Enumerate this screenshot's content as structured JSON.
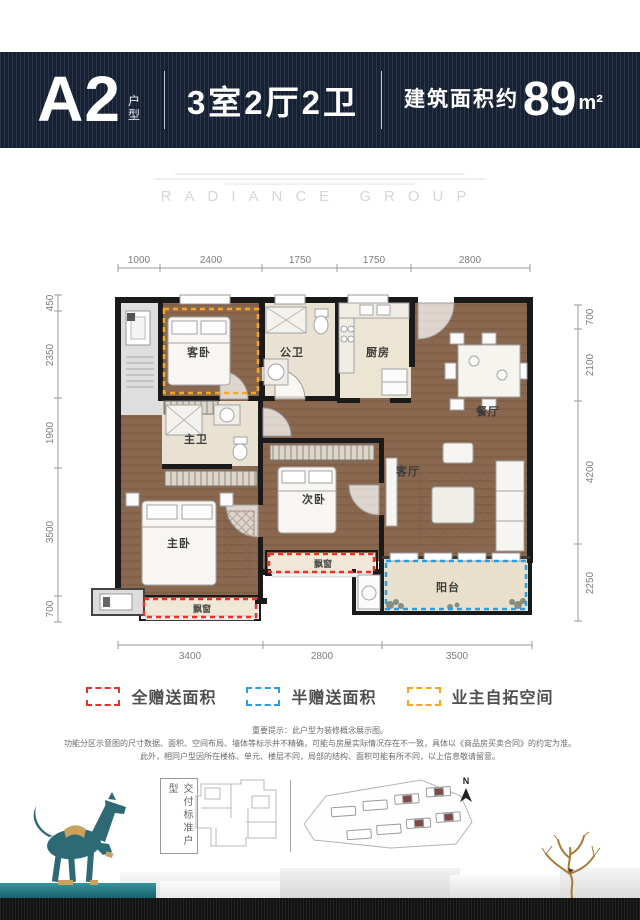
{
  "header": {
    "unit_code": "A2",
    "unit_code_suffix": "户型",
    "layout_summary": "3室2厅2卫",
    "area_prefix": "建筑面积约",
    "area_value": "89",
    "area_unit": "m²"
  },
  "watermark": "RADIANCE GROUP",
  "floorplan": {
    "rooms": {
      "guest_bedroom": "客卧",
      "public_bathroom": "公卫",
      "kitchen": "厨房",
      "dining_room": "餐厅",
      "master_bathroom": "主卫",
      "master_bedroom": "主卧",
      "second_bedroom": "次卧",
      "living_room": "客厅",
      "balcony": "阳台",
      "bay_window_master": "飘窗",
      "bay_window_second": "飘窗"
    },
    "dims": {
      "top": [
        "1000",
        "2400",
        "1750",
        "1750",
        "2800"
      ],
      "left": [
        "450",
        "2350",
        "1900",
        "3500",
        "700"
      ],
      "right": [
        "700",
        "2100",
        "4200",
        "2250"
      ],
      "bottom": [
        "3400",
        "2800",
        "3500"
      ]
    }
  },
  "legend": [
    {
      "label": "全赠送面积",
      "color": "#e8312a"
    },
    {
      "label": "半赠送面积",
      "color": "#2a9fe0"
    },
    {
      "label": "业主自拓空间",
      "color": "#f5a623"
    }
  ],
  "disclaimer": {
    "line1": "重要提示：此户型为装修概念展示图。",
    "line2": "功能分区示意图的尺寸数据、面积、空间布局、墙体等标示并不精确，可能与房屋实际情况存在不一致，具体以《商品房买卖合同》的约定为准。",
    "line3": "此外，相同户型因所在楼栋、单元、楼层不同，局部的结构、面积可能有所不同，以上信息敬请留意。"
  },
  "footer": {
    "delivery_standard_label": "交付标准户型",
    "north_label": "N"
  },
  "colors": {
    "header_bg": "#18212f",
    "full_gift_red": "#e8312a",
    "half_gift_blue": "#2a9fe0",
    "owner_expand_orange": "#f5a623",
    "wood_floor": "#8a6850",
    "horse_teal": "#2e6a73"
  }
}
